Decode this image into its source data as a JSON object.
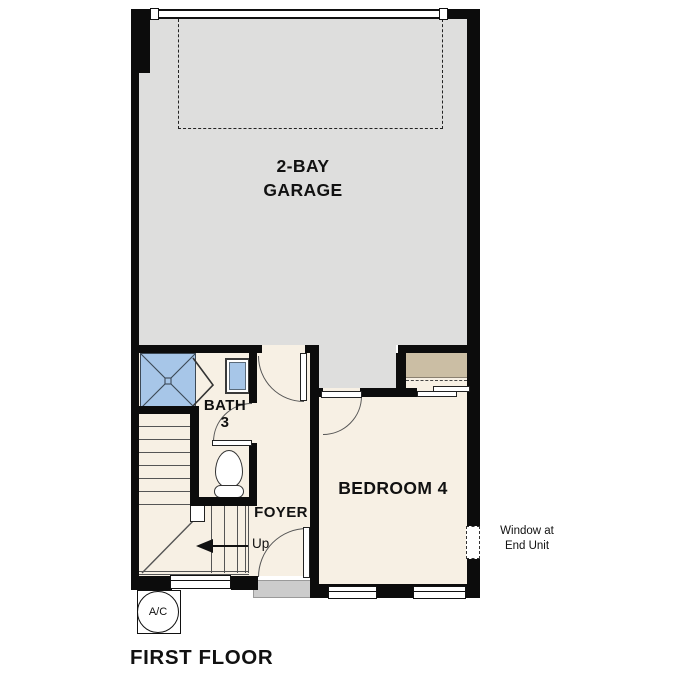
{
  "title": "FIRST FLOOR",
  "colors": {
    "wall": "#0c0c0c",
    "floor": "#f7f0e4",
    "garage": "#dededd",
    "fixture-blue": "#a7c6e8",
    "closet-tan": "#cbbea4",
    "threshold": "#cccccc"
  },
  "rooms": {
    "garage": {
      "line1": "2-BAY",
      "line2": "GARAGE"
    },
    "bath": {
      "label": "BATH",
      "number": "3"
    },
    "bedroom": {
      "label": "BEDROOM 4"
    },
    "foyer": {
      "label": "FOYER"
    },
    "stairs": {
      "direction_label": "Up"
    }
  },
  "annotations": {
    "window_note_line1": "Window at",
    "window_note_line2": "End Unit",
    "ac_label": "A/C"
  }
}
